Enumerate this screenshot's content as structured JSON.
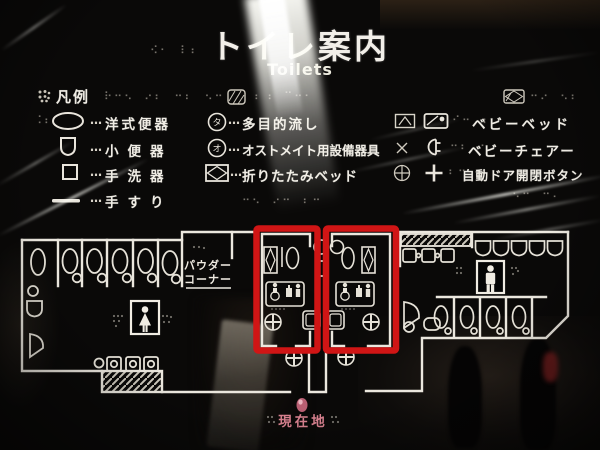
{
  "sign": {
    "title": "トイレ案内",
    "subtitle": "Toilets"
  },
  "legend": {
    "header": "凡例",
    "leader": "…",
    "items": [
      {
        "symbol": "western-toilet-icon",
        "label": "洋式便器"
      },
      {
        "symbol": "urinal-icon",
        "label": "小便器"
      },
      {
        "symbol": "hand-basin-icon",
        "label": "手洗器"
      },
      {
        "symbol": "handrail-icon",
        "label": "手すり"
      },
      {
        "symbol": "multi-purpose-sink-icon",
        "label": "多目的流し"
      },
      {
        "symbol": "ostomate-fixture-icon",
        "label": "オストメイト用設備器具"
      },
      {
        "symbol": "folding-bed-icon",
        "label": "折りたたみベッド"
      },
      {
        "symbol": "baby-bed-icon",
        "label": "ベビーベッド"
      },
      {
        "symbol": "baby-chair-icon",
        "label": "ベビーチェアー"
      },
      {
        "symbol": "auto-door-button-icon",
        "label": "自動ドア開閉ボタン"
      }
    ]
  },
  "map": {
    "powder_corner_line1": "パウダー",
    "powder_corner_line2": "コーナー",
    "current_location": "現在地",
    "highlight_color": "#d01515",
    "location_color": "#d6808e",
    "line_color": "#ece8e0"
  },
  "braille": {
    "b1": "⠪⠂⠀⠇⠆",
    "b2": "⠗⠒⠢⠀⠔⠆⠀⠒⠆⠀⠢⠒",
    "b3": "⠆⠰⠀⠉⠒⠂",
    "b4": "⠒⠔⠀⠢⠆",
    "b5": "⠊⠒⠀⠆",
    "b6": "⠒⠆⠀⠂",
    "b7": "⠆⠒⠀⠰",
    "b8": "⠒⠢⠀⠔⠒⠀⠆⠒",
    "b9": "⠢⠒⠀⠒⠄",
    "b10": "⠨⠆"
  }
}
